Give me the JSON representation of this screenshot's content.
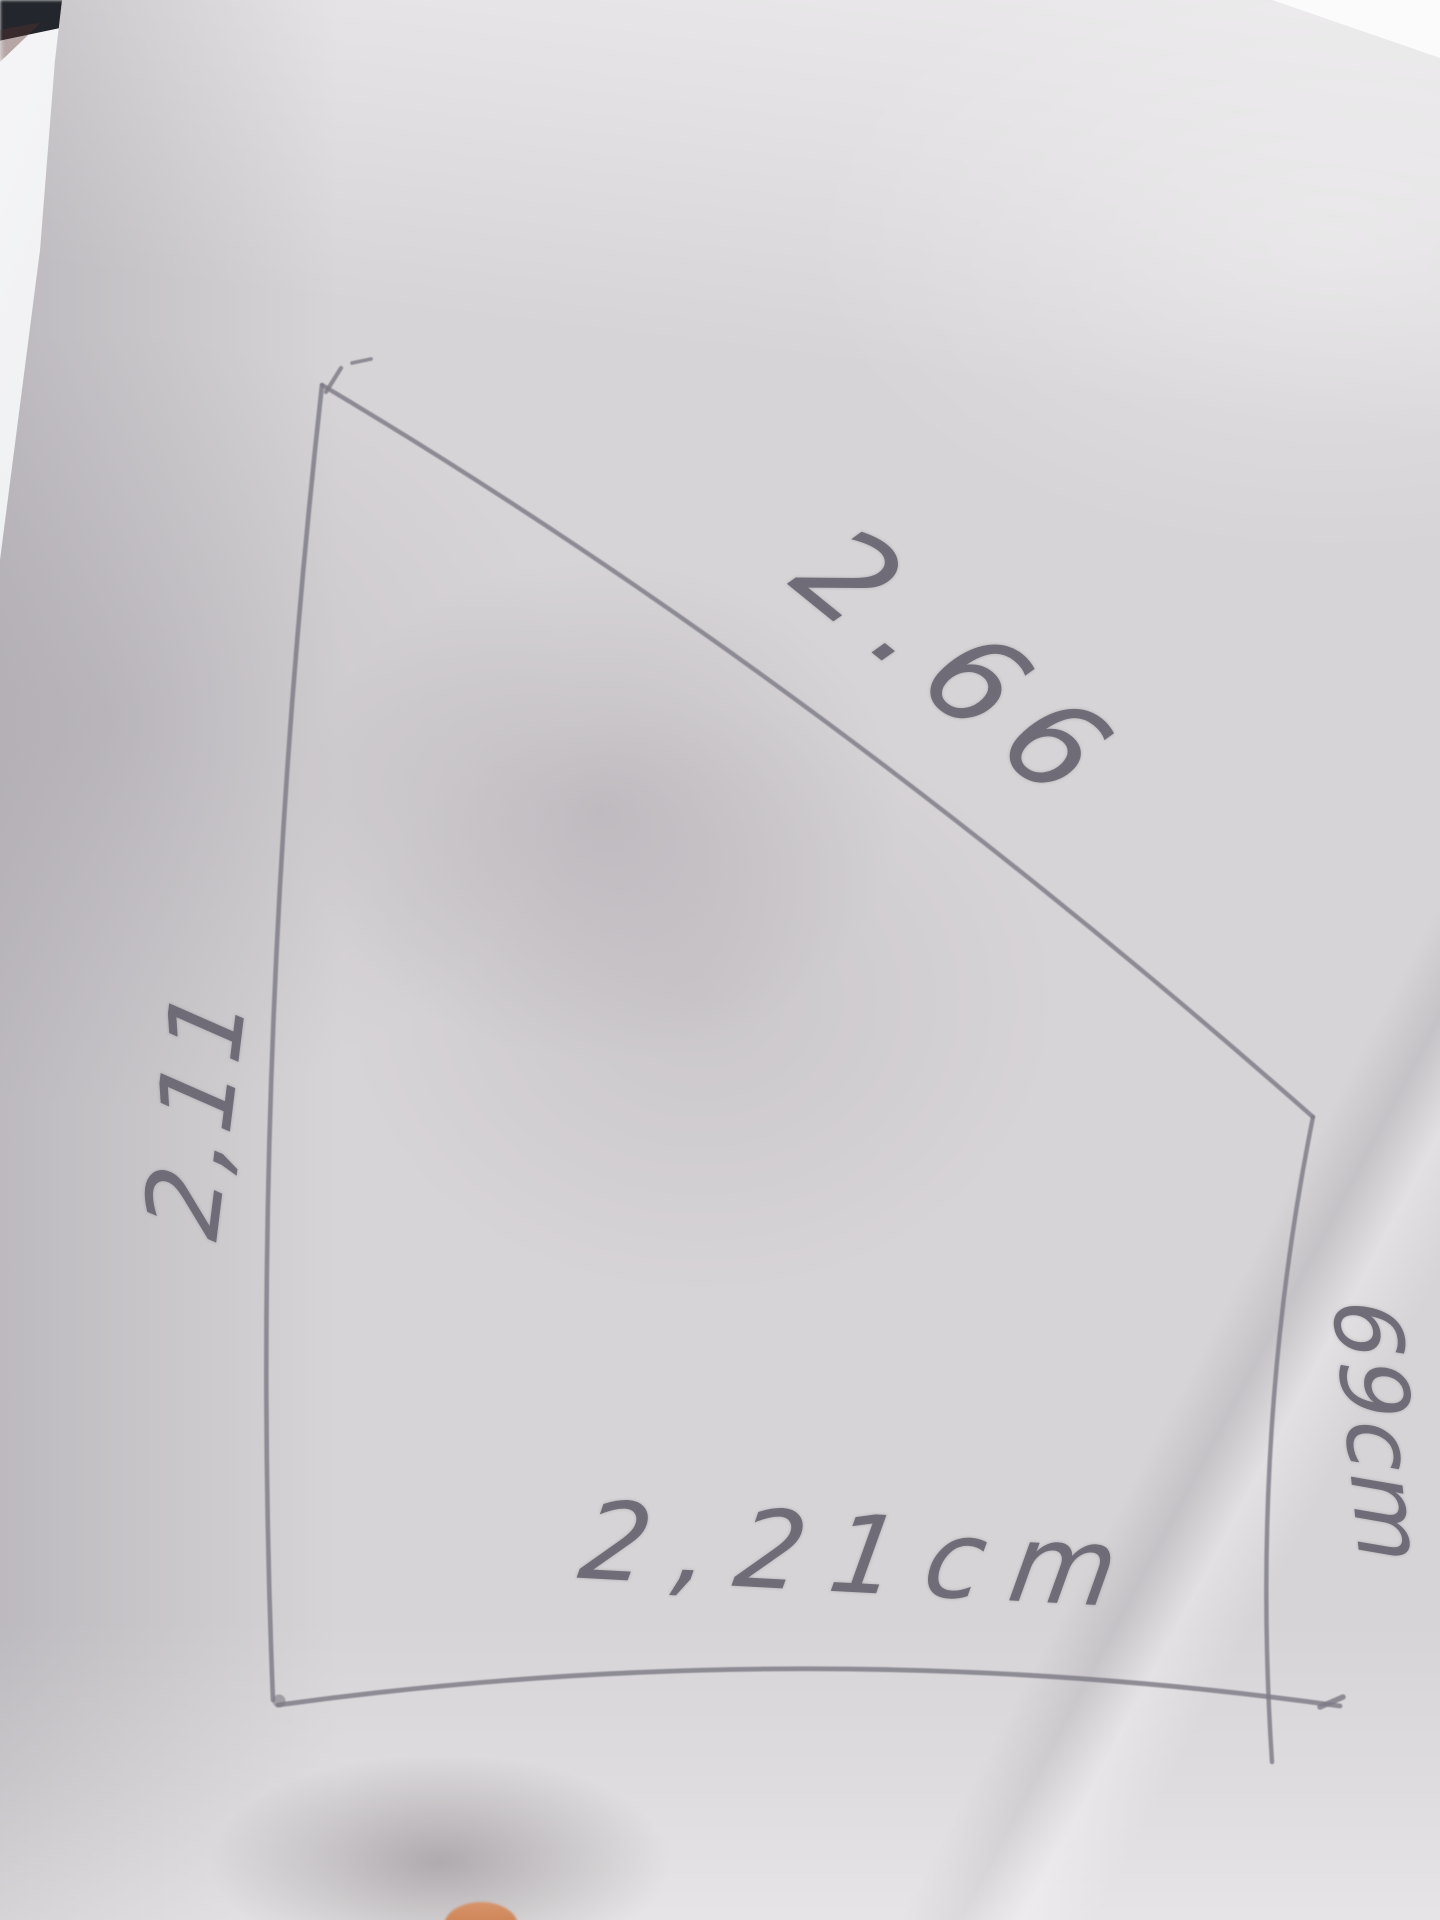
{
  "scene": {
    "description": "Photo of a pencil hand-drawn four-sided shape (quadrilateral) sketched on a sheet of paper, with a measurement written along each side",
    "labels": {
      "top_side": "2.66",
      "left_side": "2,11",
      "right_side": "69cm",
      "bottom_side": "2,21cm"
    },
    "colors": {
      "pencil": "#7d7a85",
      "paper": "#d7d4d7",
      "paper_highlight": "#e6e5e8",
      "backing_sheet": "#f2f2f4",
      "background": "#fbfbfc",
      "dark_object": "#23262c",
      "fingertip": "#cf8757"
    }
  }
}
